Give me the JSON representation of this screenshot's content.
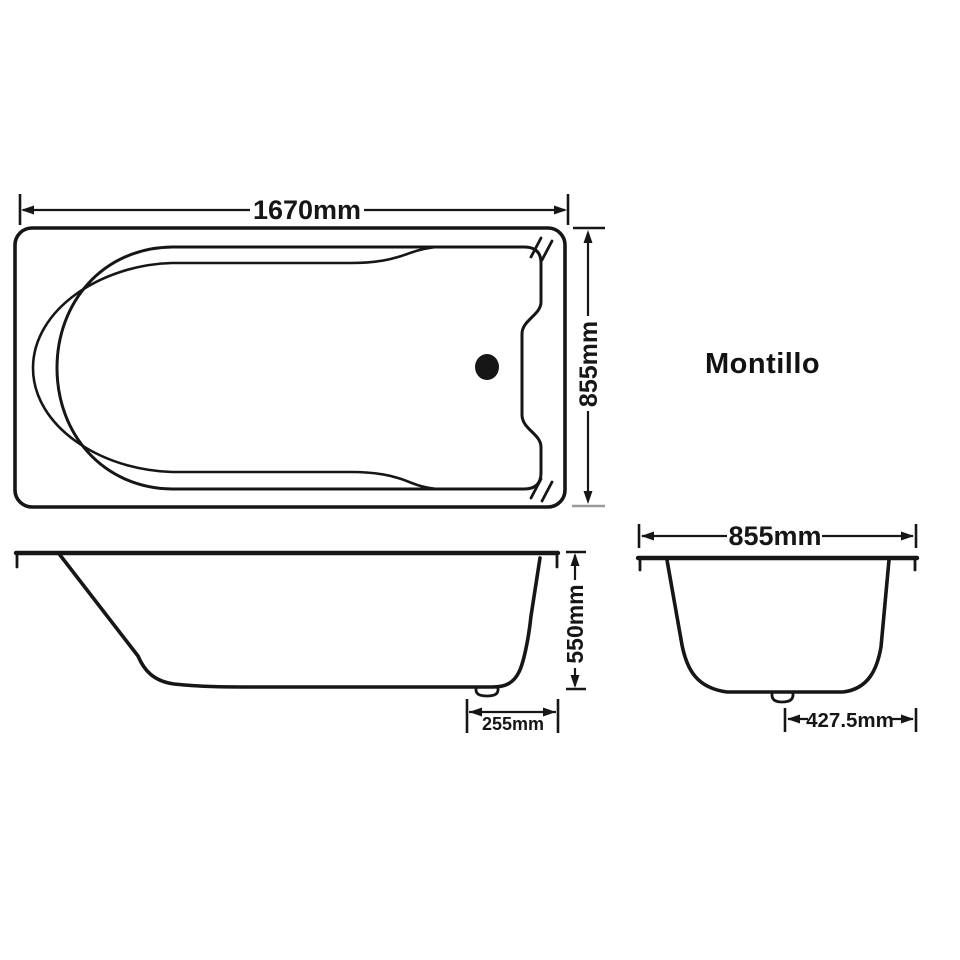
{
  "brand": {
    "name": "Montillo"
  },
  "colors": {
    "background": "#ffffff",
    "ink": "#161616"
  },
  "dimensions": {
    "top_view": {
      "length": "1670mm",
      "width": "855mm"
    },
    "side_view": {
      "height": "550mm",
      "drain_offset": "255mm"
    },
    "end_view": {
      "width": "855mm",
      "center_to_edge": "427.5mm"
    }
  }
}
